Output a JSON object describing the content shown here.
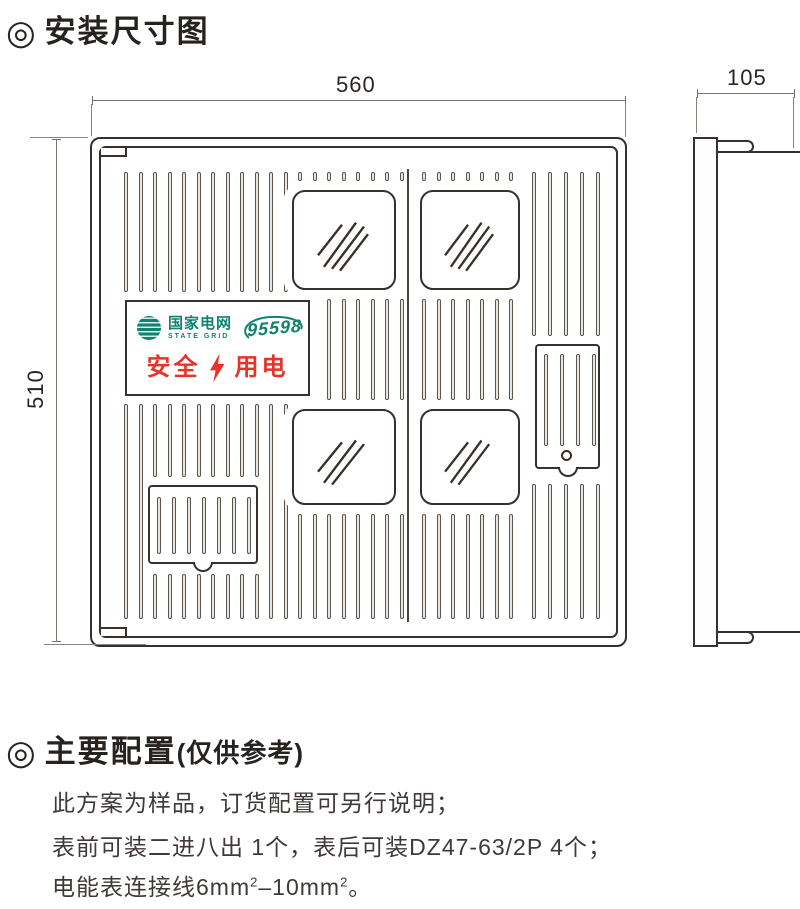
{
  "sections": {
    "install": {
      "bullet": "◎",
      "title": "安装尺寸图"
    },
    "config": {
      "bullet": "◎",
      "title": "主要配置",
      "suffix": "(仅供参考)"
    }
  },
  "diagram": {
    "type": "installation-dimension-drawing",
    "views": {
      "front": "meter-box front with 4 viewing windows",
      "side": "meter-box side profile"
    },
    "dimensions": {
      "width": "560",
      "height": "510",
      "depth": "105"
    }
  },
  "plate": {
    "brand_cn": "国家电网",
    "brand_en": "STATE GRID",
    "hotline": "95598",
    "slogan_left": "安全",
    "slogan_right": "用电",
    "colors": {
      "brand_green": "#108270",
      "slogan_red": "#e5342b"
    }
  },
  "notes": {
    "line1": "此方案为样品，订货配置可另行说明；",
    "line2": "表前可装二进八出 1个，表后可装DZ47-63/2P 4个；",
    "line3": {
      "a": "电能表连接线6mm",
      "a_sup": "2",
      "b": "–10mm",
      "b_sup": "2",
      "c": "。"
    }
  }
}
